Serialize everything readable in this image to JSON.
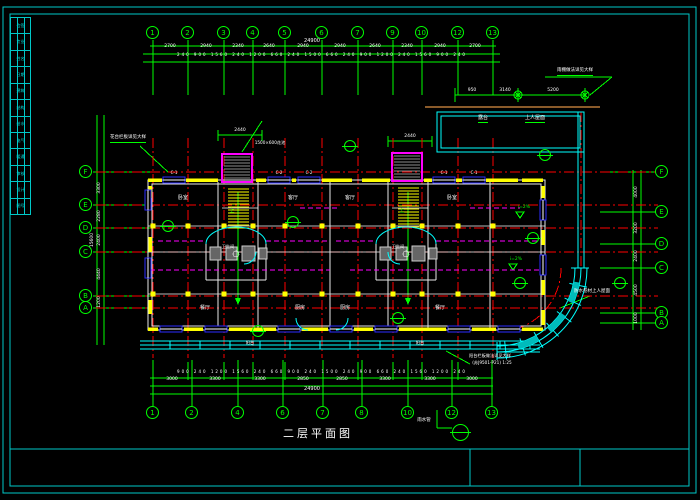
{
  "sheet": {
    "title": "二层平面图",
    "frame_color": "#00c8c8"
  },
  "colors": {
    "grid": "#00ff00",
    "axis": "#ff0000",
    "wall": "#e8e8e8",
    "wall_fill": "#ffff00",
    "window": "#2b2bff",
    "stair_bay": "#ff00ff",
    "balcony": "#00ffff",
    "terrace_edge": "#8a5a2a",
    "text": "#ffffff"
  },
  "axes": {
    "top": [
      {
        "label": "1",
        "x": 153
      },
      {
        "label": "2",
        "x": 188
      },
      {
        "label": "3",
        "x": 224
      },
      {
        "label": "4",
        "x": 253
      },
      {
        "label": "5",
        "x": 285
      },
      {
        "label": "6",
        "x": 322
      },
      {
        "label": "7",
        "x": 358
      },
      {
        "label": "9",
        "x": 393
      },
      {
        "label": "10",
        "x": 422
      },
      {
        "label": "12",
        "x": 458
      },
      {
        "label": "13",
        "x": 493
      }
    ],
    "bottom": [
      {
        "label": "1",
        "x": 153
      },
      {
        "label": "2",
        "x": 192
      },
      {
        "label": "4",
        "x": 238
      },
      {
        "label": "6",
        "x": 283
      },
      {
        "label": "7",
        "x": 323
      },
      {
        "label": "8",
        "x": 362
      },
      {
        "label": "10",
        "x": 408
      },
      {
        "label": "12",
        "x": 452
      },
      {
        "label": "13",
        "x": 492
      }
    ],
    "left": [
      {
        "label": "F",
        "y": 172
      },
      {
        "label": "E",
        "y": 205
      },
      {
        "label": "D",
        "y": 228
      },
      {
        "label": "C",
        "y": 252
      },
      {
        "label": "B",
        "y": 296
      },
      {
        "label": "A",
        "y": 308
      }
    ],
    "right": [
      {
        "label": "F",
        "y": 172
      },
      {
        "label": "E",
        "y": 212
      },
      {
        "label": "D",
        "y": 244
      },
      {
        "label": "C",
        "y": 268
      },
      {
        "label": "B",
        "y": 313
      },
      {
        "label": "A",
        "y": 323
      }
    ]
  },
  "dim_labels": [
    {
      "t": "2700",
      "x": 170,
      "y": 45,
      "s": 4.5
    },
    {
      "t": "2940",
      "x": 206,
      "y": 45,
      "s": 4.5
    },
    {
      "t": "2340",
      "x": 238,
      "y": 45,
      "s": 4.5
    },
    {
      "t": "2640",
      "x": 269,
      "y": 45,
      "s": 4.5
    },
    {
      "t": "2940",
      "x": 303,
      "y": 45,
      "s": 4.5
    },
    {
      "t": "2940",
      "x": 340,
      "y": 45,
      "s": 4.5
    },
    {
      "t": "2640",
      "x": 375,
      "y": 45,
      "s": 4.5
    },
    {
      "t": "2340",
      "x": 407,
      "y": 45,
      "s": 4.5
    },
    {
      "t": "2940",
      "x": 440,
      "y": 45,
      "s": 4.5
    },
    {
      "t": "2700",
      "x": 475,
      "y": 45,
      "s": 4.5
    },
    {
      "t": "240 900 1560 240 1200 660 240 1500 660 240 900 1200 240 1560 900 240",
      "x": 322,
      "y": 53,
      "s": 4,
      "sp": 1
    },
    {
      "t": "24900",
      "x": 312,
      "y": 39,
      "s": 5
    },
    {
      "t": "950",
      "x": 472,
      "y": 89,
      "s": 4.5
    },
    {
      "t": "3140",
      "x": 505,
      "y": 89,
      "s": 4.5
    },
    {
      "t": "5200",
      "x": 553,
      "y": 89,
      "s": 4.5
    },
    {
      "t": "2440",
      "x": 240,
      "y": 129,
      "s": 4.5
    },
    {
      "t": "2440",
      "x": 410,
      "y": 135,
      "s": 4.5
    },
    {
      "t": "3000",
      "x": 172,
      "y": 378,
      "s": 4.5
    },
    {
      "t": "3300",
      "x": 215,
      "y": 378,
      "s": 4.5
    },
    {
      "t": "3300",
      "x": 260,
      "y": 378,
      "s": 4.5
    },
    {
      "t": "2850",
      "x": 303,
      "y": 378,
      "s": 4.5
    },
    {
      "t": "2850",
      "x": 342,
      "y": 378,
      "s": 4.5
    },
    {
      "t": "3300",
      "x": 385,
      "y": 378,
      "s": 4.5
    },
    {
      "t": "3300",
      "x": 430,
      "y": 378,
      "s": 4.5
    },
    {
      "t": "3000",
      "x": 472,
      "y": 378,
      "s": 4.5
    },
    {
      "t": "900 240 1200 1560 240 660 900 240 1500 240 900 660 240 1560 1200 240",
      "x": 322,
      "y": 370,
      "s": 4,
      "sp": 1
    },
    {
      "t": "24900",
      "x": 312,
      "y": 387,
      "s": 5
    },
    {
      "t": "3300",
      "x": 100,
      "y": 188,
      "s": 4.5,
      "r": 1
    },
    {
      "t": "2280",
      "x": 100,
      "y": 216,
      "s": 4.5,
      "r": 1
    },
    {
      "t": "2400",
      "x": 100,
      "y": 240,
      "s": 4.5,
      "r": 1
    },
    {
      "t": "4440",
      "x": 100,
      "y": 274,
      "s": 4.5,
      "r": 1
    },
    {
      "t": "1200",
      "x": 100,
      "y": 302,
      "s": 4.5,
      "r": 1
    },
    {
      "t": "15600",
      "x": 93,
      "y": 240,
      "s": 4.5,
      "r": 1
    },
    {
      "t": "4000",
      "x": 637,
      "y": 192,
      "s": 4.5,
      "r": 1
    },
    {
      "t": "3200",
      "x": 637,
      "y": 228,
      "s": 4.5,
      "r": 1
    },
    {
      "t": "2400",
      "x": 637,
      "y": 256,
      "s": 4.5,
      "r": 1
    },
    {
      "t": "4500",
      "x": 637,
      "y": 290,
      "s": 4.5,
      "r": 1
    },
    {
      "t": "1000",
      "x": 637,
      "y": 318,
      "s": 4.5,
      "r": 1
    }
  ],
  "annotations": [
    {
      "t": "花台栏板详见大样",
      "x": 128,
      "y": 136,
      "s": 4.5,
      "u": 1
    },
    {
      "t": "1500×600花池",
      "x": 270,
      "y": 141,
      "s": 4.2
    },
    {
      "t": "雨棚做法详见大样",
      "x": 575,
      "y": 69,
      "s": 4.5,
      "u": 1
    },
    {
      "t": "露台",
      "x": 483,
      "y": 116,
      "s": 5,
      "u": 1
    },
    {
      "t": "上人屋面",
      "x": 535,
      "y": 116,
      "s": 5,
      "u": 1
    },
    {
      "t": "防水卷材上人屋面",
      "x": 592,
      "y": 290,
      "s": 4.5
    },
    {
      "t": "i=2%",
      "x": 524,
      "y": 206,
      "s": 4.5,
      "c": "#00ff00"
    },
    {
      "t": "i=2%",
      "x": 516,
      "y": 258,
      "s": 4.5,
      "c": "#00ff00"
    },
    {
      "t": "雨水管",
      "x": 424,
      "y": 419,
      "s": 4.5
    },
    {
      "t": "阳台栏板做法详见大样",
      "x": 490,
      "y": 354,
      "s": 4.2
    },
    {
      "t": "(苏J9501-P21) 1:25",
      "x": 492,
      "y": 361,
      "s": 4.2
    },
    {
      "t": "上",
      "x": 232,
      "y": 209,
      "s": 5,
      "c": "#00ff00"
    },
    {
      "t": "上",
      "x": 402,
      "y": 209,
      "s": 5,
      "c": "#00ff00"
    },
    {
      "t": "C-1",
      "x": 174,
      "y": 171,
      "s": 4
    },
    {
      "t": "C-2",
      "x": 279,
      "y": 171,
      "s": 4
    },
    {
      "t": "C-2",
      "x": 309,
      "y": 171,
      "s": 4
    },
    {
      "t": "C-1",
      "x": 444,
      "y": 171,
      "s": 4
    },
    {
      "t": "C-1",
      "x": 474,
      "y": 171,
      "s": 4
    }
  ],
  "rooms": [
    {
      "t": "卧室",
      "x": 183,
      "y": 196,
      "s": 5
    },
    {
      "t": "客厅",
      "x": 293,
      "y": 196,
      "s": 5
    },
    {
      "t": "客厅",
      "x": 350,
      "y": 196,
      "s": 5
    },
    {
      "t": "卧室",
      "x": 452,
      "y": 196,
      "s": 5
    },
    {
      "t": "卫生间",
      "x": 228,
      "y": 245,
      "s": 4.2
    },
    {
      "t": "卫生间",
      "x": 398,
      "y": 245,
      "s": 4.2
    },
    {
      "t": "餐厅",
      "x": 205,
      "y": 306,
      "s": 5
    },
    {
      "t": "厨房",
      "x": 300,
      "y": 306,
      "s": 5
    },
    {
      "t": "厨房",
      "x": 345,
      "y": 306,
      "s": 5
    },
    {
      "t": "餐厅",
      "x": 440,
      "y": 306,
      "s": 5
    },
    {
      "t": "阳台",
      "x": 250,
      "y": 341,
      "s": 4.2
    },
    {
      "t": "阳台",
      "x": 420,
      "y": 341,
      "s": 4.2
    }
  ],
  "callouts": [
    {
      "x": 293,
      "y": 222
    },
    {
      "x": 350,
      "y": 146
    },
    {
      "x": 545,
      "y": 155
    },
    {
      "x": 533,
      "y": 238
    },
    {
      "x": 520,
      "y": 283
    },
    {
      "x": 620,
      "y": 283
    },
    {
      "x": 258,
      "y": 331
    },
    {
      "x": 168,
      "y": 226
    },
    {
      "x": 398,
      "y": 318
    },
    {
      "x": 460,
      "y": 432,
      "big": 1
    }
  ],
  "title_block_rows": [
    "会签",
    "专业",
    "姓名",
    "日期",
    "建筑",
    "结构",
    "给水",
    "电气",
    "暖通",
    "审核",
    "设计",
    "图号"
  ]
}
